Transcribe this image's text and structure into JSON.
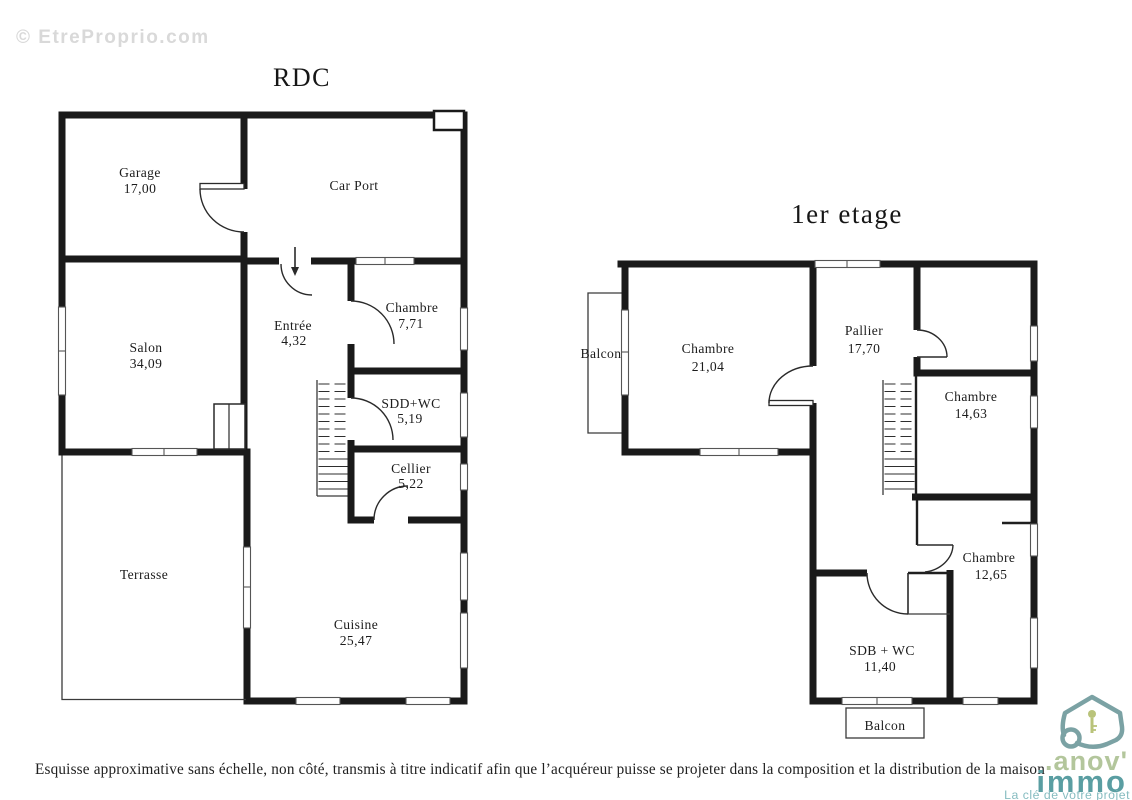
{
  "watermark": "© EtreProprio.com",
  "colors": {
    "wall": "#1a1a1a",
    "logo_house": "#7ba2a4",
    "logo_green": "#b3c69c",
    "logo_teal": "#5a9ea2",
    "logo_light_teal": "#86bcc0",
    "watermark_gray": "#d9d9d9"
  },
  "plans": {
    "rdc": {
      "title": "RDC",
      "rooms": {
        "garage": {
          "name": "Garage",
          "area": "17,00"
        },
        "carport": {
          "name": "Car Port"
        },
        "salon": {
          "name": "Salon",
          "area": "34,09"
        },
        "entree": {
          "name": "Entrée",
          "area": "4,32"
        },
        "chambre": {
          "name": "Chambre",
          "area": "7,71"
        },
        "sdd": {
          "name": "SDD+WC",
          "area": "5,19"
        },
        "cellier": {
          "name": "Cellier",
          "area": "5,22"
        },
        "terrasse": {
          "name": "Terrasse"
        },
        "cuisine": {
          "name": "Cuisine",
          "area": "25,47"
        }
      }
    },
    "etage": {
      "title": "1er etage",
      "rooms": {
        "balcon_gauche": {
          "name": "Balcon"
        },
        "chambre21": {
          "name": "Chambre",
          "area": "21,04"
        },
        "pallier": {
          "name": "Pallier",
          "area": "17,70"
        },
        "chambre14": {
          "name": "Chambre",
          "area": "14,63"
        },
        "chambre12": {
          "name": "Chambre",
          "area": "12,65"
        },
        "sdb": {
          "name": "SDB + WC",
          "area": "11,40"
        },
        "balcon_bas": {
          "name": "Balcon"
        }
      }
    }
  },
  "footer": {
    "disclaimer": "Esquisse approximative sans échelle, non côté, transmis à titre indicatif afin que l’acquéreur puisse se projeter dans la composition et la distribution de la maison"
  },
  "logo": {
    "brand_line1": ".anov'",
    "brand_line2": "immo",
    "tagline": "La clé de votre projet"
  }
}
